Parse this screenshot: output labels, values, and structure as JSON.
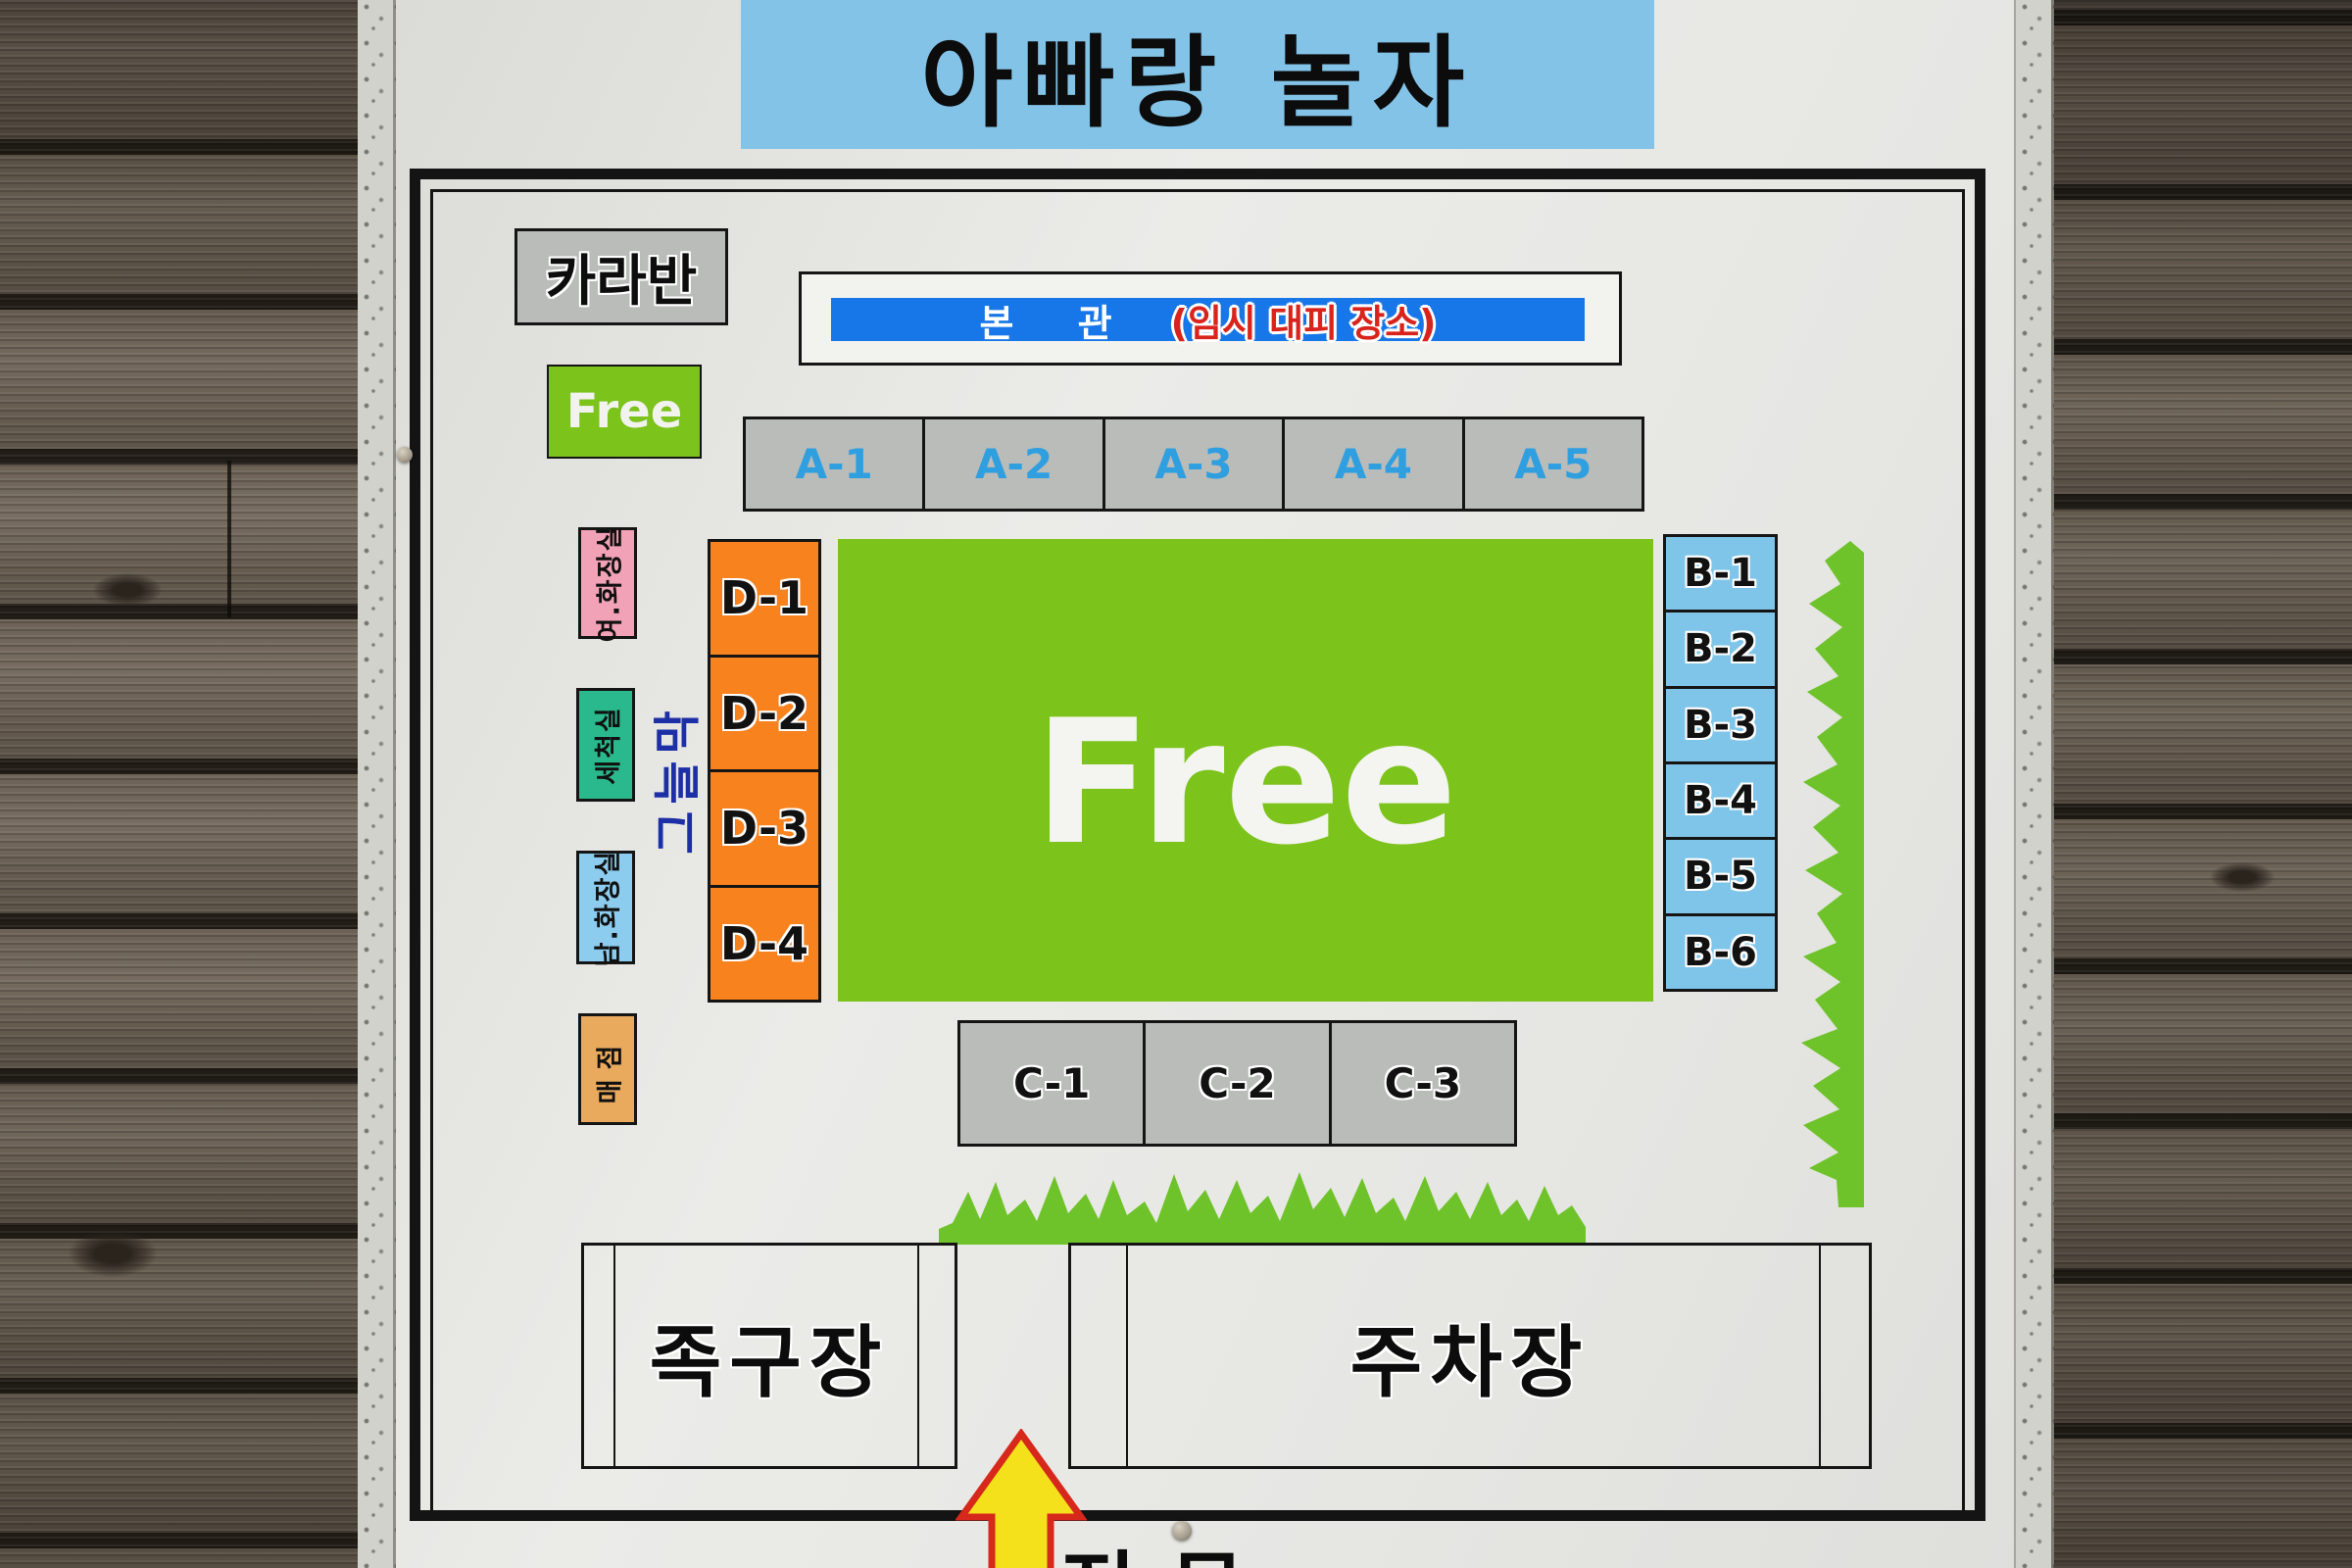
{
  "sign": {
    "title": "아빠랑 놀자",
    "caravan_label": "카라반",
    "free_small_label": "Free",
    "free_area_label": "Free",
    "main_building": {
      "label": "본 관",
      "note": "(임시 대피 장소)"
    },
    "a_sites": [
      "A-1",
      "A-2",
      "A-3",
      "A-4",
      "A-5"
    ],
    "d_sites": [
      "D-1",
      "D-2",
      "D-3",
      "D-4"
    ],
    "b_sites": [
      "B-1",
      "B-2",
      "B-3",
      "B-4",
      "B-5",
      "B-6"
    ],
    "c_sites": [
      "C-1",
      "C-2",
      "C-3"
    ],
    "facilities": {
      "women_restroom": "여.화장실",
      "wash_room": "세척실",
      "men_restroom": "남.화장실",
      "store": "매점",
      "shade_canopy": "그늘막",
      "foot_volleyball_court": "족구장",
      "parking_lot": "주차장",
      "main_gate": "정문"
    },
    "colors": {
      "banner_blue": "#84c3e8",
      "bar_blue": "#1777e8",
      "note_red": "#d8241c",
      "site_gray": "#b9bcb9",
      "a_text_blue": "#2f9fe0",
      "free_green": "#7cc31c",
      "d_orange": "#f8821e",
      "b_blue": "#7fc5e9",
      "pink": "#f2a2b6",
      "teal": "#2ab98c",
      "light_blue": "#8cccee",
      "tan": "#e9aa5e",
      "grass_green": "#6fc32a",
      "arrow_yellow": "#f4e11b",
      "arrow_red": "#d7281c",
      "shade_text_blue": "#1d2fa6"
    }
  }
}
